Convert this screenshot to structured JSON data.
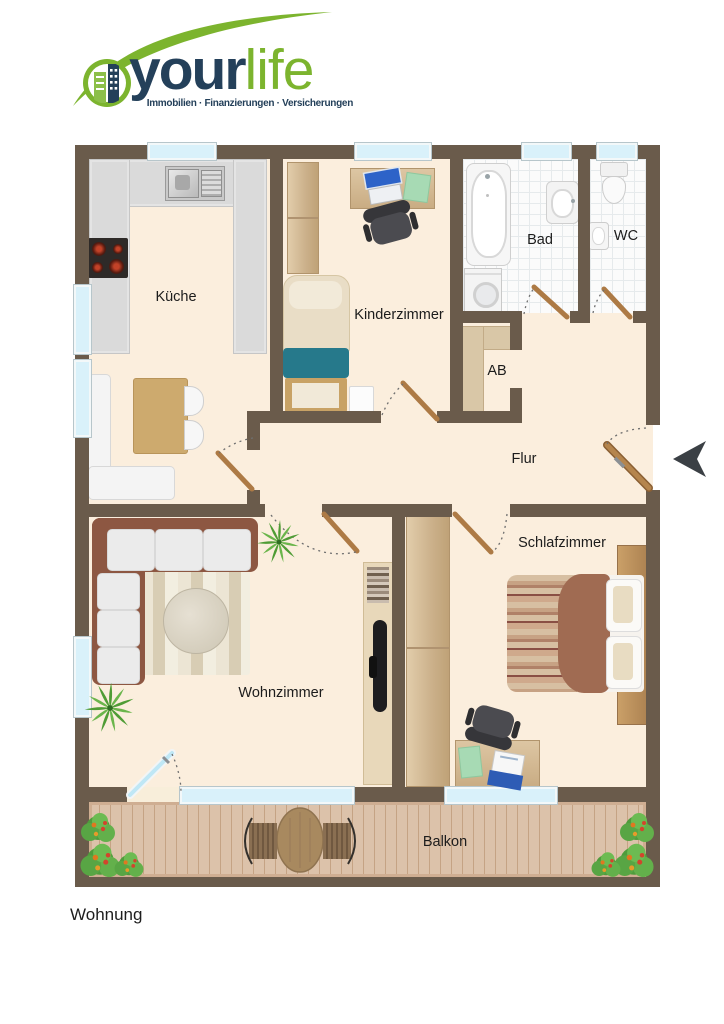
{
  "logo": {
    "brand_bold": "your",
    "brand_light": "life",
    "tagline": "Immobilien · Finanzierungen · Versicherungen"
  },
  "rooms": {
    "kueche": {
      "label": "Küche"
    },
    "kinderzimmer": {
      "label": "Kinderzimmer"
    },
    "bad": {
      "label": "Bad"
    },
    "wc": {
      "label": "WC"
    },
    "ab": {
      "label": "AB"
    },
    "flur": {
      "label": "Flur"
    },
    "wohnzimmer": {
      "label": "Wohnzimmer"
    },
    "schlafzimmer": {
      "label": "Schlafzimmer"
    },
    "balkon": {
      "label": "Balkon"
    }
  },
  "plan_title": "Wohnung",
  "colors": {
    "brand_navy": "#24405a",
    "brand_green": "#7cb42e",
    "wall_brown": "#6a5b4b",
    "floor_cream": "#fbeedd",
    "window_blue": "#d9f1fa",
    "door_wood": "#ad7a45",
    "deck_wood": "#dcc2aa",
    "bed_teal": "#26798b",
    "sofa_brown": "#8d5742"
  }
}
